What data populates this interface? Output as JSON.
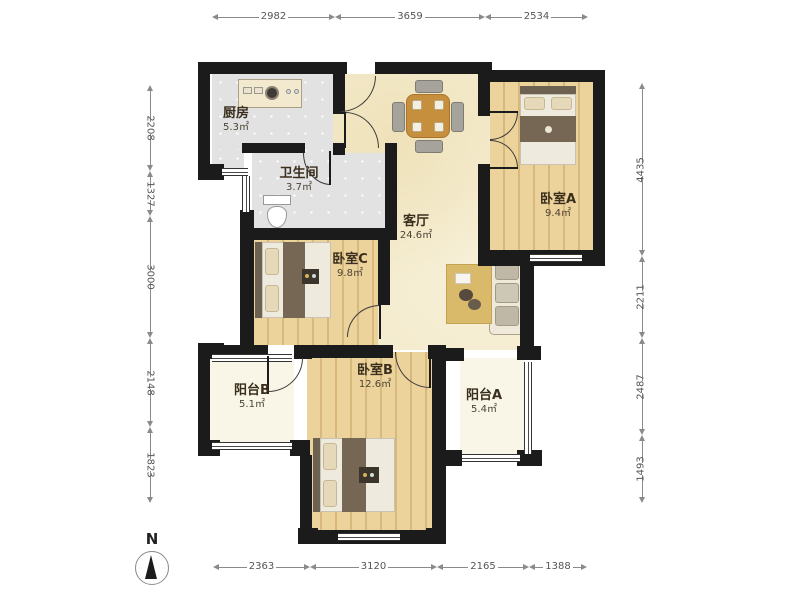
{
  "plan": {
    "rooms": [
      {
        "id": "kitchen",
        "name": "厨房",
        "area": "5.3㎡"
      },
      {
        "id": "bathroom",
        "name": "卫生间",
        "area": "3.7㎡"
      },
      {
        "id": "living",
        "name": "客厅",
        "area": "24.6㎡"
      },
      {
        "id": "bedroomA",
        "name": "卧室A",
        "area": "9.4㎡"
      },
      {
        "id": "bedroomC",
        "name": "卧室C",
        "area": "9.8㎡"
      },
      {
        "id": "bedroomB",
        "name": "卧室B",
        "area": "12.6㎡"
      },
      {
        "id": "balconyB",
        "name": "阳台B",
        "area": "5.1㎡"
      },
      {
        "id": "balconyA",
        "name": "阳台A",
        "area": "5.4㎡"
      }
    ],
    "dimensions_mm": {
      "top": [
        "2982",
        "3659",
        "2534"
      ],
      "bottom": [
        "2363",
        "3120",
        "2165",
        "1388"
      ],
      "left": [
        "2208",
        "1327",
        "3000",
        "2148",
        "1823"
      ],
      "right": [
        "4435",
        "2211",
        "2487",
        "1493"
      ]
    },
    "compass": {
      "label": "N"
    },
    "colors": {
      "wall": "#1b1b1b",
      "living_floor": "#f4ebcd",
      "wood_floor": "#ecd29b",
      "tile_floor": "#e2e2e2",
      "balcony_floor": "#f9f6e7"
    }
  }
}
